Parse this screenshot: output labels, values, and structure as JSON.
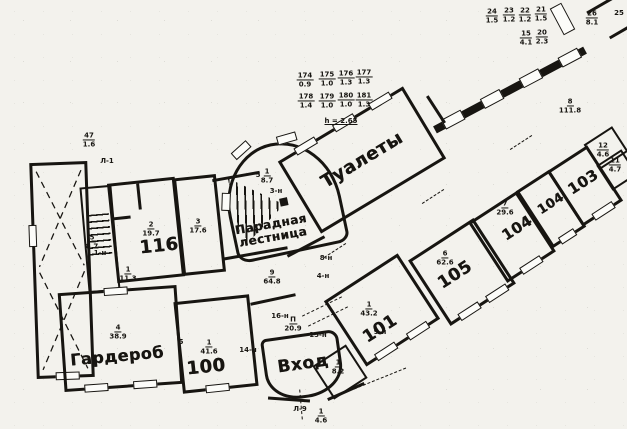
{
  "palette": {
    "ink": "#171511",
    "paper": "#f3f2ed"
  },
  "room_labels": {
    "toilets": "Туалеты",
    "paradnaya_1": "Парадная",
    "paradnaya_2": "лестница",
    "garderob": "Гардероб",
    "vhod": "Вход",
    "r116": "116",
    "r100": "100",
    "r101": "101",
    "r105": "105",
    "r104a": "104",
    "r104b": "104",
    "r103": "103"
  },
  "fractions": [
    {
      "num": "47",
      "den": "1.6",
      "x": 89,
      "y": 140
    },
    {
      "num": "174",
      "den": "0.9",
      "x": 305,
      "y": 80
    },
    {
      "num": "175",
      "den": "1.0",
      "x": 327,
      "y": 79
    },
    {
      "num": "176",
      "den": "1.3",
      "x": 346,
      "y": 78
    },
    {
      "num": "177",
      "den": "1.3",
      "x": 364,
      "y": 77
    },
    {
      "num": "178",
      "den": "1.4",
      "x": 306,
      "y": 101
    },
    {
      "num": "179",
      "den": "1.0",
      "x": 327,
      "y": 101
    },
    {
      "num": "180",
      "den": "1.0",
      "x": 346,
      "y": 100
    },
    {
      "num": "181",
      "den": "1.3",
      "x": 364,
      "y": 100
    },
    {
      "num": "24",
      "den": "1.5",
      "x": 492,
      "y": 16
    },
    {
      "num": "23",
      "den": "1.2",
      "x": 509,
      "y": 15
    },
    {
      "num": "22",
      "den": "1.2",
      "x": 525,
      "y": 15
    },
    {
      "num": "21",
      "den": "1.5",
      "x": 541,
      "y": 14
    },
    {
      "num": "15",
      "den": "4.1",
      "x": 526,
      "y": 38
    },
    {
      "num": "20",
      "den": "2.3",
      "x": 542,
      "y": 37
    },
    {
      "num": "26",
      "den": "8.1",
      "x": 592,
      "y": 18
    },
    {
      "num": "8",
      "den": "111.8",
      "x": 570,
      "y": 106
    },
    {
      "num": "1",
      "den": "8.7",
      "x": 267,
      "y": 176
    },
    {
      "num": "2",
      "den": "19.7",
      "x": 151,
      "y": 229
    },
    {
      "num": "3",
      "den": "17.6",
      "x": 198,
      "y": 226
    },
    {
      "num": "5",
      "den": "8.7",
      "x": 92,
      "y": 242
    },
    {
      "num": "1",
      "den": "11.3",
      "x": 128,
      "y": 274
    },
    {
      "num": "4",
      "den": "38.9",
      "x": 118,
      "y": 332
    },
    {
      "num": "1",
      "den": "41.6",
      "x": 209,
      "y": 347
    },
    {
      "num": "9",
      "den": "64.8",
      "x": 272,
      "y": 277
    },
    {
      "num": "П",
      "den": "20.9",
      "x": 293,
      "y": 324
    },
    {
      "num": "1",
      "den": "8.2",
      "x": 338,
      "y": 367
    },
    {
      "num": "1",
      "den": "4.6",
      "x": 321,
      "y": 416
    },
    {
      "num": "1",
      "den": "43.2",
      "x": 369,
      "y": 309
    },
    {
      "num": "6",
      "den": "62.6",
      "x": 445,
      "y": 258
    },
    {
      "num": "7",
      "den": "29.6",
      "x": 505,
      "y": 208
    },
    {
      "num": "12",
      "den": "4.6",
      "x": 603,
      "y": 150
    },
    {
      "num": "11",
      "den": "4.7",
      "x": 615,
      "y": 165
    }
  ],
  "tags": [
    {
      "text": "h = 2.65",
      "x": 341,
      "y": 121,
      "underline": true
    },
    {
      "text": "25",
      "x": 619,
      "y": 13
    },
    {
      "text": "Л-1",
      "x": 107,
      "y": 161
    },
    {
      "text": "Л-9",
      "x": 300,
      "y": 409
    },
    {
      "text": "1-н",
      "x": 100,
      "y": 253
    },
    {
      "text": "3-н",
      "x": 276,
      "y": 191
    },
    {
      "text": "4-н",
      "x": 323,
      "y": 276
    },
    {
      "text": "8-н",
      "x": 326,
      "y": 258
    },
    {
      "text": "9-н",
      "x": 380,
      "y": 332
    },
    {
      "text": "14-н",
      "x": 248,
      "y": 350
    },
    {
      "text": "15-н",
      "x": 318,
      "y": 335
    },
    {
      "text": "16-н",
      "x": 280,
      "y": 316
    },
    {
      "text": "5",
      "x": 258,
      "y": 175
    },
    {
      "text": "5",
      "x": 181,
      "y": 342
    }
  ]
}
